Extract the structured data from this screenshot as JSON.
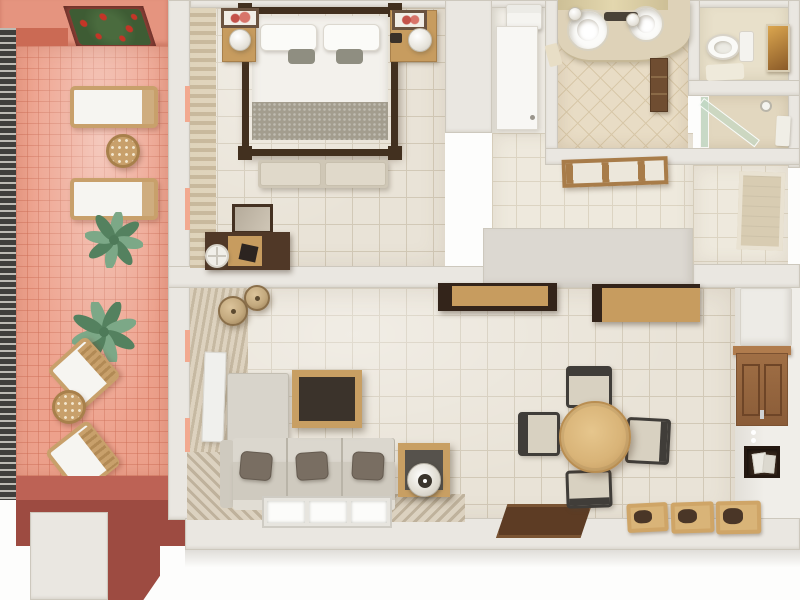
{
  "scene": {
    "type": "apartment-floor-plan-3d-top-view",
    "rooms": [
      {
        "name": "terrace",
        "items": [
          "flower-planter",
          "railing",
          "sun-lounger",
          "sun-lounger",
          "round-wicker-table",
          "palm-plant",
          "palm-plant",
          "wicker-armchair",
          "wicker-armchair",
          "round-wicker-table",
          "bench"
        ]
      },
      {
        "name": "bedroom",
        "items": [
          "canopy-double-bed",
          "pillow",
          "pillow",
          "blanket",
          "foot-bench",
          "nightstand-with-lamp",
          "nightstand-with-lamp",
          "wall-picture",
          "wall-picture",
          "desk",
          "mirror",
          "stool",
          "curtains"
        ]
      },
      {
        "name": "entry-hall",
        "items": [
          "entrance-door",
          "doormat",
          "towel-shelf",
          "bathroom-door"
        ]
      },
      {
        "name": "bathroom",
        "items": [
          "double-sink-vanity",
          "mirror-strip",
          "wall-lamp",
          "wall-lamp",
          "faucet",
          "wooden-cabinet",
          "hand-towel"
        ]
      },
      {
        "name": "toilet-room",
        "items": [
          "toilet",
          "bath-mat",
          "wall-art"
        ]
      },
      {
        "name": "shower-room",
        "items": [
          "glass-enclosure",
          "shower-head",
          "towel"
        ]
      },
      {
        "name": "living-room",
        "items": [
          "corner-sofa",
          "seat-pillow",
          "seat-pillow",
          "seat-pillow",
          "coffee-table",
          "side-table-with-lamp",
          "wicker-pendant-lamp",
          "wicker-pendant-lamp",
          "folding-screen",
          "window",
          "vertical-blinds",
          "deck-strip"
        ]
      },
      {
        "name": "dining-area",
        "items": [
          "round-dining-table",
          "dining-chair",
          "dining-chair",
          "dining-chair",
          "dining-chair",
          "dark-rug",
          "planter-tray",
          "planter-tray",
          "planter-tray",
          "wall-cabinet",
          "wall-niche",
          "hanging-shelf",
          "hanging-shelf",
          "tall-cabinet"
        ]
      }
    ]
  },
  "palette": {
    "outside": "#fdfdfc",
    "wall": "#eae7e1",
    "wall_edge": "#cdc8bd",
    "wall_face": "#f0eee9",
    "gray_block": "#dcd8d1",
    "floor_main": "#e9e3d7",
    "floor_grid": "#d2c9b7",
    "floor_hall": "#eee9dd",
    "hall_grid": "#dcd4c2",
    "bath_floor": "#e8dcc5",
    "bath_grid": "#d8c8a9",
    "wc_floor": "#e8e0ca",
    "terrace_wall": "#e5947f",
    "terrace_floor": "#eda18c",
    "red_parapet": "#cb6a54",
    "red_bench": "#bd6255",
    "red_dark": "#9d4b41",
    "planter_red": "#8d4036",
    "railing_dark": "#403f3c",
    "railing_light": "#bdbbb4",
    "wood_dark": "#42301f",
    "wood_dark2": "#33241a",
    "wood_mid": "#9c6b45",
    "wood_light": "#c79c5f",
    "wood_pale": "#d9b478",
    "wicker": "#c8a06b",
    "lamp_wicker": "#c3a97e",
    "sofa_light": "#d8d4cb",
    "sofa_mid": "#cfcabf",
    "sofa_back": "#dbd7ce",
    "chair_seat": "#d8d1c1",
    "pillow": "#796e62",
    "coffee_top": "#3b332b",
    "rug_brown": "#5d3c24",
    "rug_edge": "#7a5433",
    "bush_green": "#3e5c34",
    "green_leaf": "#7ca887",
    "green_dark": "#54815f",
    "flower_red": "#c43527",
    "glass_green": "#c5dbc9",
    "white_obj": "#f6f5f1",
    "curtain_a": "#dfd3ba",
    "curtain_b": "#c7b79a"
  }
}
